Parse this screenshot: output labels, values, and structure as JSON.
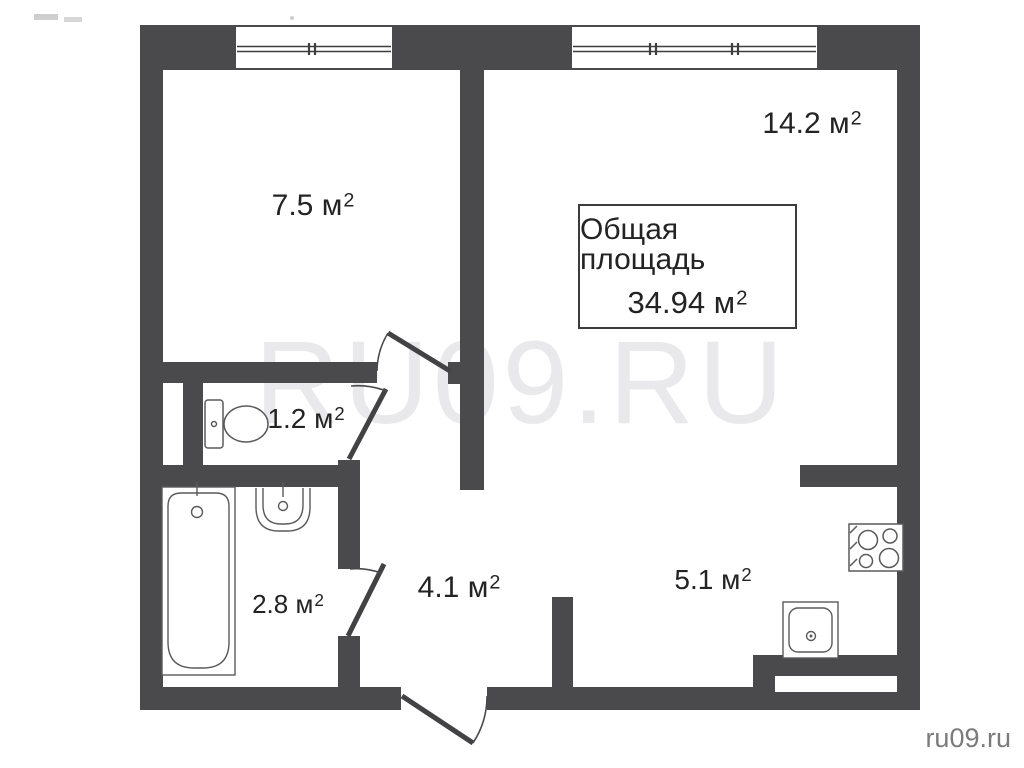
{
  "watermark": "RU09.RU",
  "credit": "ru09.ru",
  "total": {
    "title": "Общая площадь",
    "value_label": "34.94 м",
    "sup": "2",
    "area_m2": 34.94
  },
  "rooms": [
    {
      "key": "room-top-left",
      "area_label": "7.5 м",
      "sup": "2",
      "area_m2": 7.5
    },
    {
      "key": "room-top-right",
      "area_label": "14.2 м",
      "sup": "2",
      "area_m2": 14.2
    },
    {
      "key": "toilet",
      "area_label": "1.2 м",
      "sup": "2",
      "area_m2": 1.2
    },
    {
      "key": "bathroom",
      "area_label": "2.8 м",
      "sup": "2",
      "area_m2": 2.8
    },
    {
      "key": "hallway",
      "area_label": "4.1 м",
      "sup": "2",
      "area_m2": 4.1
    },
    {
      "key": "kitchen",
      "area_label": "5.1 м",
      "sup": "2",
      "area_m2": 5.1
    }
  ],
  "colors": {
    "wall": "#4a4a4d",
    "label_text": "#232323",
    "watermark": "#e9e9eb",
    "credit_text": "#7b7b7b",
    "fixture_stroke": "#5a5a5c",
    "background": "#ffffff"
  }
}
